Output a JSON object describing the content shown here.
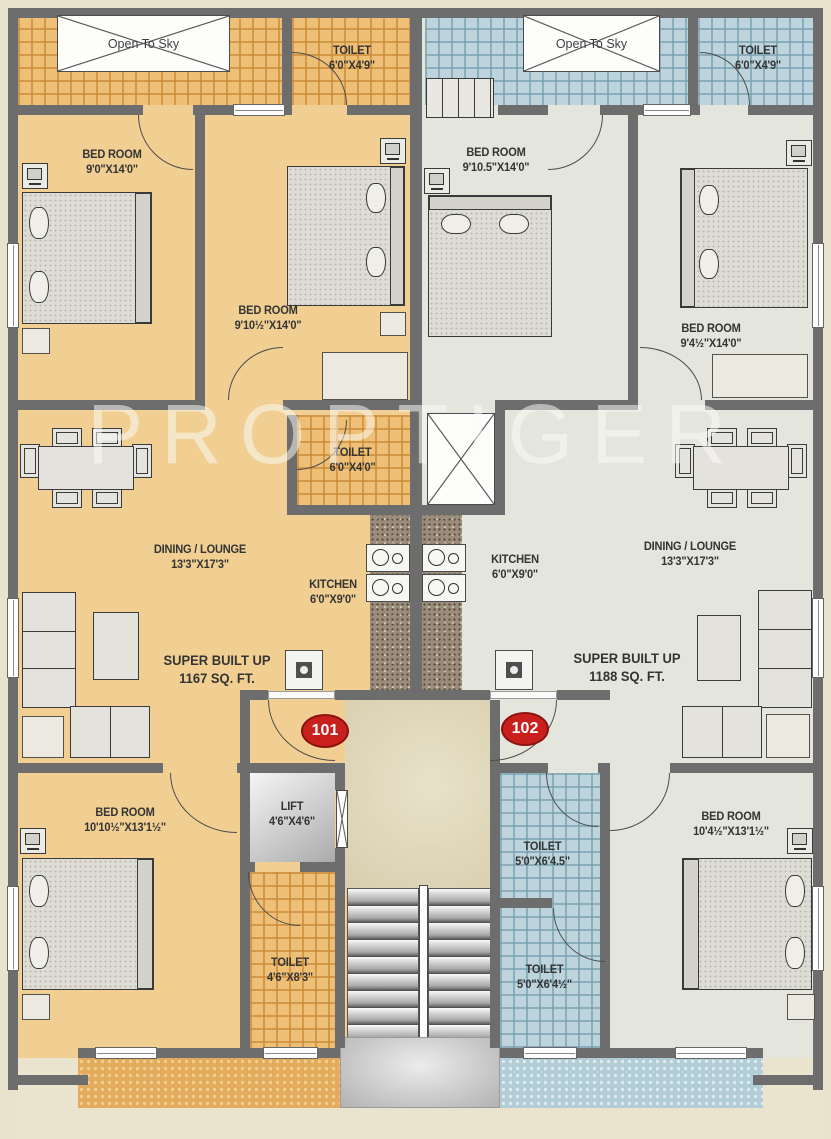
{
  "watermark": "PROPTIGER",
  "units": {
    "left": {
      "number": "101",
      "super_built_up": {
        "name": "SUPER BUILT UP",
        "dims": "1167 SQ. FT."
      }
    },
    "right": {
      "number": "102",
      "super_built_up": {
        "name": "SUPER BUILT UP",
        "dims": "1188 SQ. FT."
      }
    }
  },
  "labels": {
    "openSkyL": {
      "name": "Open To Sky"
    },
    "openSkyR": {
      "name": "Open To Sky"
    },
    "toiletTopL": {
      "name": "TOILET",
      "dims": "6'0\"X4'9\""
    },
    "toiletTopR": {
      "name": "TOILET",
      "dims": "6'0\"X4'9\""
    },
    "bed1L": {
      "name": "BED ROOM",
      "dims": "9'0\"X14'0\""
    },
    "bed2L": {
      "name": "BED ROOM",
      "dims": "9'10½\"X14'0\""
    },
    "bed1R": {
      "name": "BED ROOM",
      "dims": "9'10.5\"X14'0\""
    },
    "bed2R": {
      "name": "BED ROOM",
      "dims": "9'4½\"X14'0\""
    },
    "toiletMidL": {
      "name": "TOILET",
      "dims": "6'0\"X4'0\""
    },
    "kitchenL": {
      "name": "KITCHEN",
      "dims": "6'0\"X9'0\""
    },
    "kitchenR": {
      "name": "KITCHEN",
      "dims": "6'0\"X9'0\""
    },
    "diningL": {
      "name": "DINING / LOUNGE",
      "dims": "13'3\"X17'3\""
    },
    "diningR": {
      "name": "DINING / LOUNGE",
      "dims": "13'3\"X17'3\""
    },
    "bed3L": {
      "name": "BED ROOM",
      "dims": "10'10½\"X13'1½\""
    },
    "bed3R": {
      "name": "BED ROOM",
      "dims": "10'4½\"X13'1½\""
    },
    "lift": {
      "name": "LIFT",
      "dims": "4'6\"X4'6\""
    },
    "toiletBotL": {
      "name": "TOILET",
      "dims": "4'6\"X8'3\""
    },
    "toiletRA": {
      "name": "TOILET",
      "dims": "5'0\"X6'4.5\""
    },
    "toiletRB": {
      "name": "TOILET",
      "dims": "5'0\"X6'4½\""
    }
  },
  "palette": {
    "wall": "#6d6d6d",
    "unit_101_floor": "#f1cf92",
    "unit_102_floor": "#e4e5dc",
    "toilet_tile_101": "#eec077",
    "toilet_tile_102": "#bdd4dc",
    "badge_red": "#c9201d"
  }
}
